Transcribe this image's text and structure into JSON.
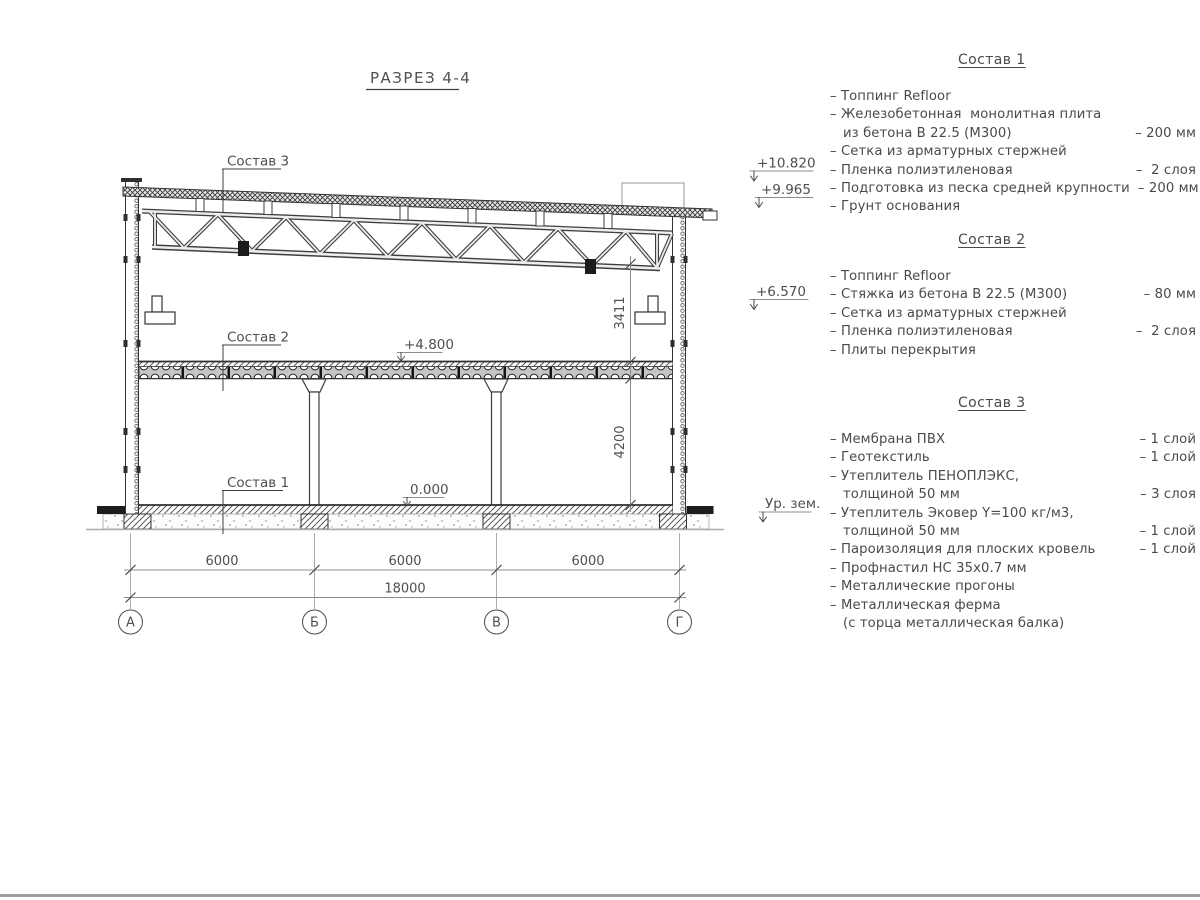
{
  "drawing": {
    "title": "РАЗРЕЗ 4-4",
    "axes": [
      "А",
      "Б",
      "В",
      "Г"
    ],
    "dims": {
      "bay1": "6000",
      "bay2": "6000",
      "bay3": "6000",
      "total": "18000",
      "truss_clearance": "3411",
      "story_height": "4200"
    },
    "elevations": {
      "parapet": "+10.820",
      "roof": "+9.965",
      "bracket": "+6.570",
      "floor2": "+4.800",
      "floor1": "0.000",
      "ground": "Ур. зем."
    },
    "layer_refs": {
      "roof": "Состав 3",
      "floor2": "Состав 2",
      "floor1": "Состав 1"
    }
  },
  "notes": {
    "sections": [
      {
        "heading": "Состав 1",
        "items": [
          {
            "text": "Топпинг Refloor",
            "value": ""
          },
          {
            "text": "Железобетонная  монолитная плита",
            "text2": "из бетона В 22.5 (М300)",
            "value": "– 200 мм"
          },
          {
            "text": "Сетка из арматурных стержней",
            "value": ""
          },
          {
            "text": "Пленка полиэтиленовая",
            "value": "–  2 слоя"
          },
          {
            "text": "Подготовка из песка средней крупности",
            "value": "– 200 мм"
          },
          {
            "text": "Грунт основания",
            "value": ""
          }
        ]
      },
      {
        "heading": "Состав 2",
        "items": [
          {
            "text": "Топпинг Refloor",
            "value": ""
          },
          {
            "text": "Стяжка из бетона В 22.5 (М300)",
            "value": "– 80 мм"
          },
          {
            "text": "Сетка из арматурных стержней",
            "value": ""
          },
          {
            "text": "Пленка полиэтиленовая",
            "value": "–  2 слоя"
          },
          {
            "text": "Плиты перекрытия",
            "value": ""
          }
        ]
      },
      {
        "heading": "Состав 3",
        "items": [
          {
            "text": "Мембрана ПВХ",
            "value": "– 1 слой"
          },
          {
            "text": "Геотекстиль",
            "value": "– 1 слой"
          },
          {
            "text": "Утеплитель ПЕНОПЛЭКС,",
            "text2": "толщиной 50 мм",
            "value": "– 3 слоя"
          },
          {
            "text": "Утеплитель Эковер Y=100 кг/м3,",
            "text2": "толщиной 50 мм",
            "value": "– 1 слой"
          },
          {
            "text": "Пароизоляция для плоских кровель",
            "value": "– 1 слой"
          },
          {
            "text": "Профнастил НС 35х0.7 мм",
            "value": ""
          },
          {
            "text": "Металлические прогоны",
            "value": ""
          },
          {
            "text": "Металлическая ферма",
            "text2": "(с торца металлическая балка)",
            "value": ""
          }
        ]
      }
    ]
  },
  "colors": {
    "line": "#333333",
    "annotation": "#8c8c8c",
    "text": "#4a4a4a",
    "background": "#ffffff"
  }
}
